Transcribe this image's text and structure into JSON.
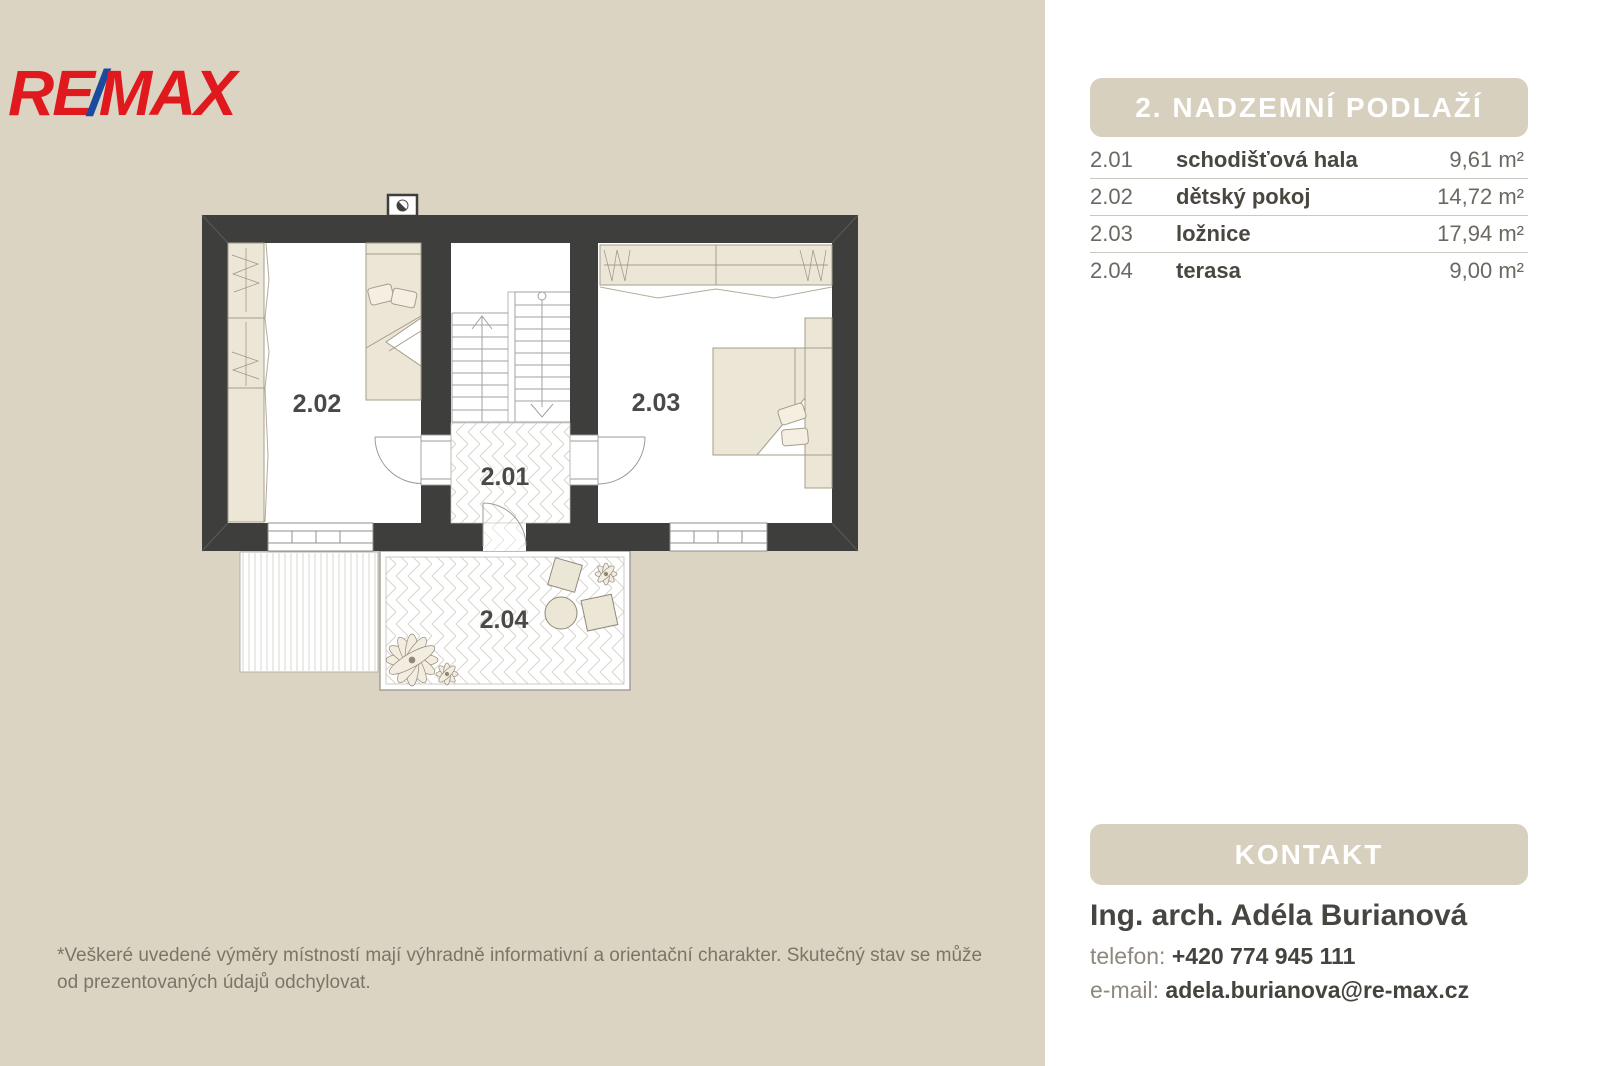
{
  "brand": {
    "re": "RE",
    "slash": "/",
    "max": "MAX",
    "red": "#E0191E",
    "blue": "#1A4B9E"
  },
  "floor_panel": {
    "title": "2. NADZEMNÍ PODLAŽÍ",
    "rooms": [
      {
        "code": "2.01",
        "name": "schodišťová hala",
        "area": "9,61 m²"
      },
      {
        "code": "2.02",
        "name": "dětský pokoj",
        "area": "14,72 m²"
      },
      {
        "code": "2.03",
        "name": "ložnice",
        "area": "17,94 m²"
      },
      {
        "code": "2.04",
        "name": "terasa",
        "area": "9,00 m²"
      }
    ]
  },
  "plan": {
    "rooms": {
      "hall": "2.01",
      "kids_room": "2.02",
      "bedroom": "2.03",
      "terrace": "2.04"
    }
  },
  "contact": {
    "title": "KONTAKT",
    "name": "Ing. arch. Adéla Burianová",
    "phone_label": "telefon:",
    "phone": "+420 774 945 111",
    "email_label": "e-mail:",
    "email": "adela.burianova@re-max.cz"
  },
  "disclaimer": {
    "line1": "*Veškeré uvedené výměry místností mají výhradně informativní a orientační charakter. Skutečný stav se může",
    "line2": "od prezentovaných údajů odchylovat."
  }
}
